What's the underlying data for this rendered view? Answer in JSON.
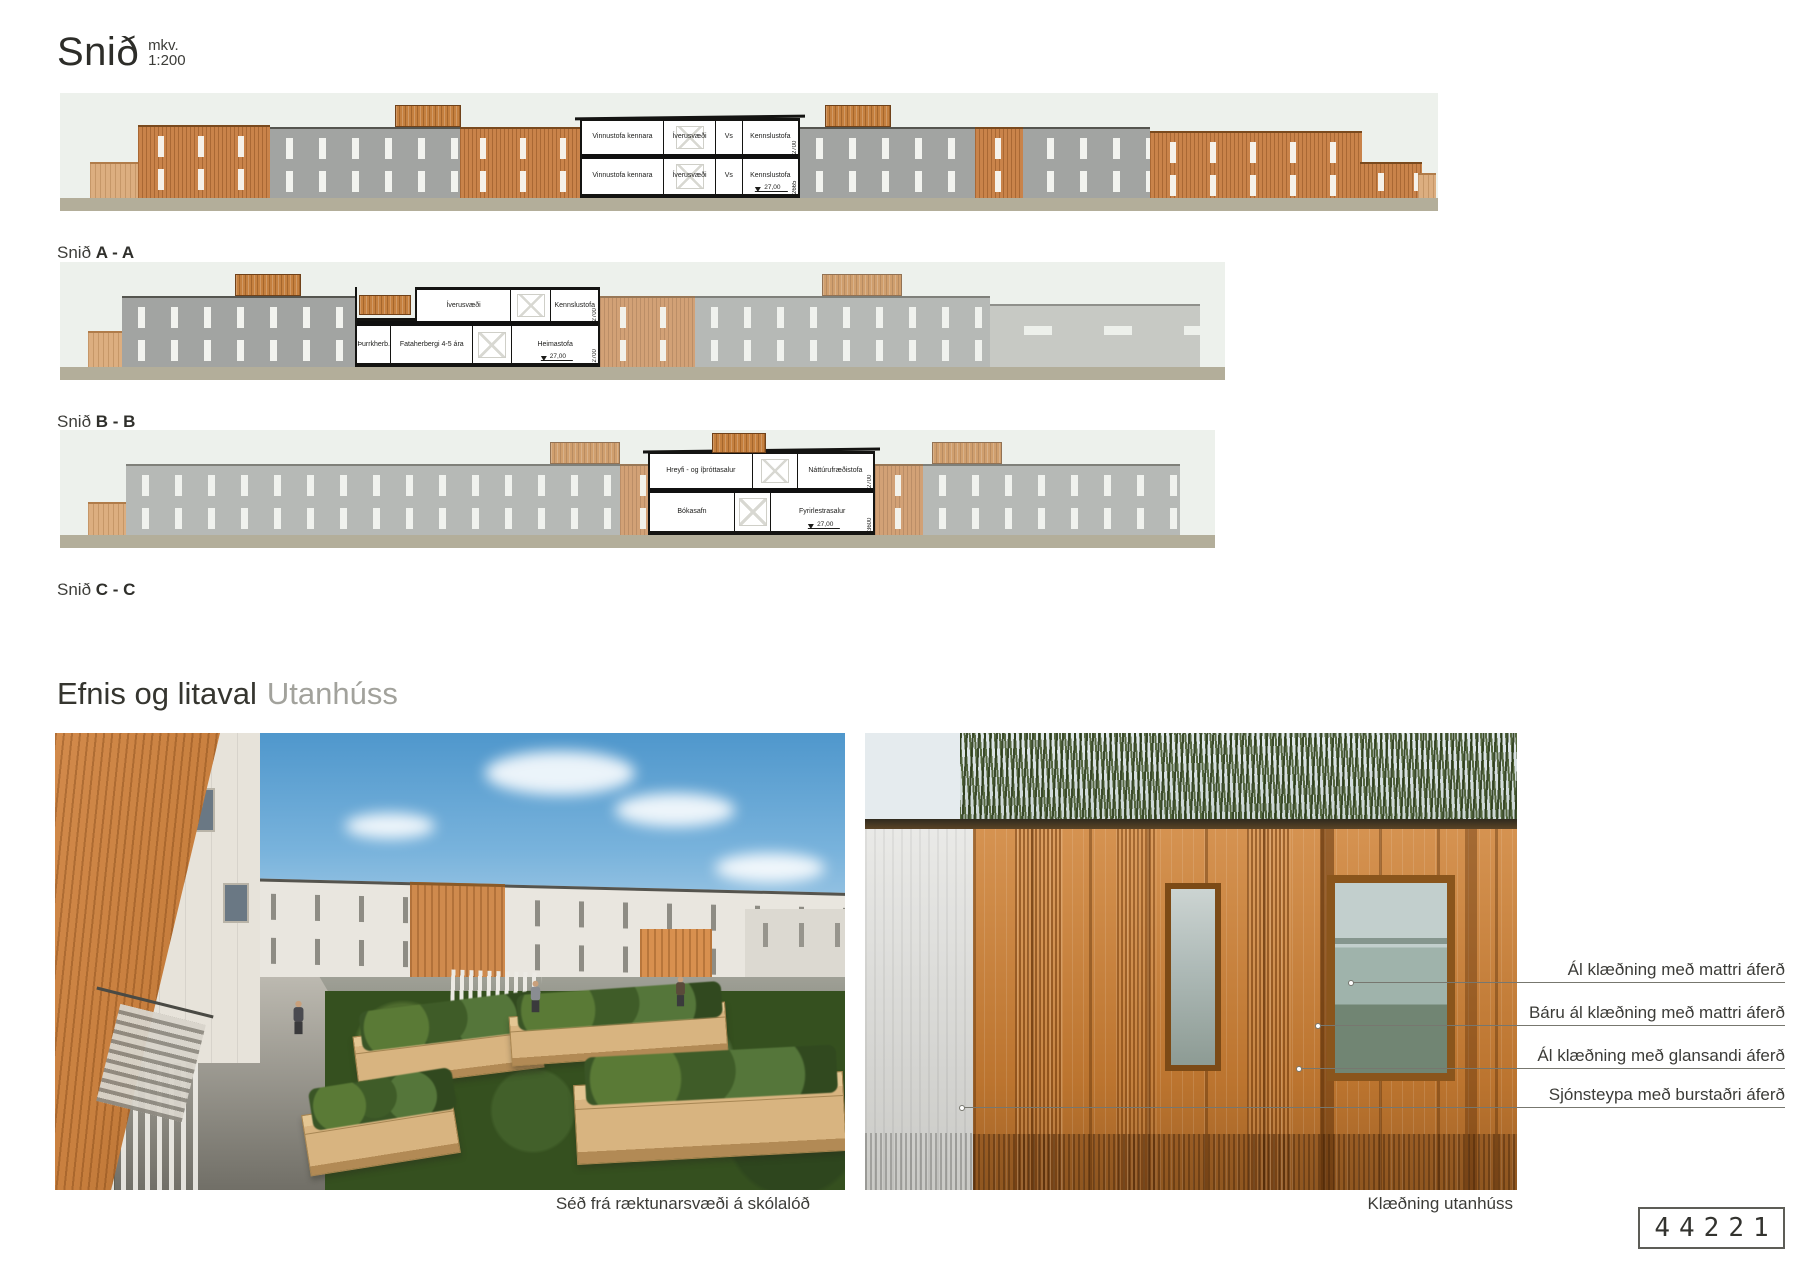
{
  "header": {
    "title": "Snið",
    "scale_line1": "mkv.",
    "scale_line2": "1:200"
  },
  "headings": {
    "materials_main": "Efnis og litaval",
    "materials_sub": "Utanhúss"
  },
  "sections": [
    {
      "prefix": "Snið",
      "name": "A - A",
      "cut": {
        "top_rooms": [
          "Vinnustofa kennara",
          "Íverusvæði",
          "Vs",
          "Kennslustofa"
        ],
        "top_dim": "2700",
        "bot_rooms": [
          "Vinnustofa kennara",
          "Íverusvæði",
          "Vs",
          "Kennslustofa"
        ],
        "bot_dim": "2665",
        "level": "27,00"
      }
    },
    {
      "prefix": "Snið",
      "name": "B - B",
      "cut": {
        "top_rooms": [
          "Íverusvæði",
          "Kennslustofa"
        ],
        "top_dim": "2700",
        "bot_rooms": [
          "Þurrkherb.",
          "Fataherbergi 4-5 ára",
          "Heimastofa"
        ],
        "bot_dim": "2700",
        "level": "27,00"
      }
    },
    {
      "prefix": "Snið",
      "name": "C - C",
      "cut": {
        "top_rooms": [
          "Hreyfi - og íþróttasalur",
          "Náttúrufræðistofa"
        ],
        "top_dim": "2700",
        "bot_rooms": [
          "Bókasafn",
          "Fyrirlestrasalur"
        ],
        "bot_dim": "3600",
        "level": "27,00"
      }
    }
  ],
  "materials": {
    "labels": [
      "Ál klæðning með mattri áferð",
      "Báru ál klæðning með mattri áferð",
      "Ál klæðning með glansandi áferð",
      "Sjónsteypa með burstaðri áferð"
    ]
  },
  "captions": {
    "left_photo": "Séð frá ræktunarsvæði á skólalóð",
    "right_photo": "Klæðning utanhúss"
  },
  "page_number": "44221",
  "colors": {
    "accent_orange": "#c9834a",
    "facade_gray": "#a2a4a2",
    "ground": "#b3ae9a",
    "sky": "#edf1ec"
  }
}
